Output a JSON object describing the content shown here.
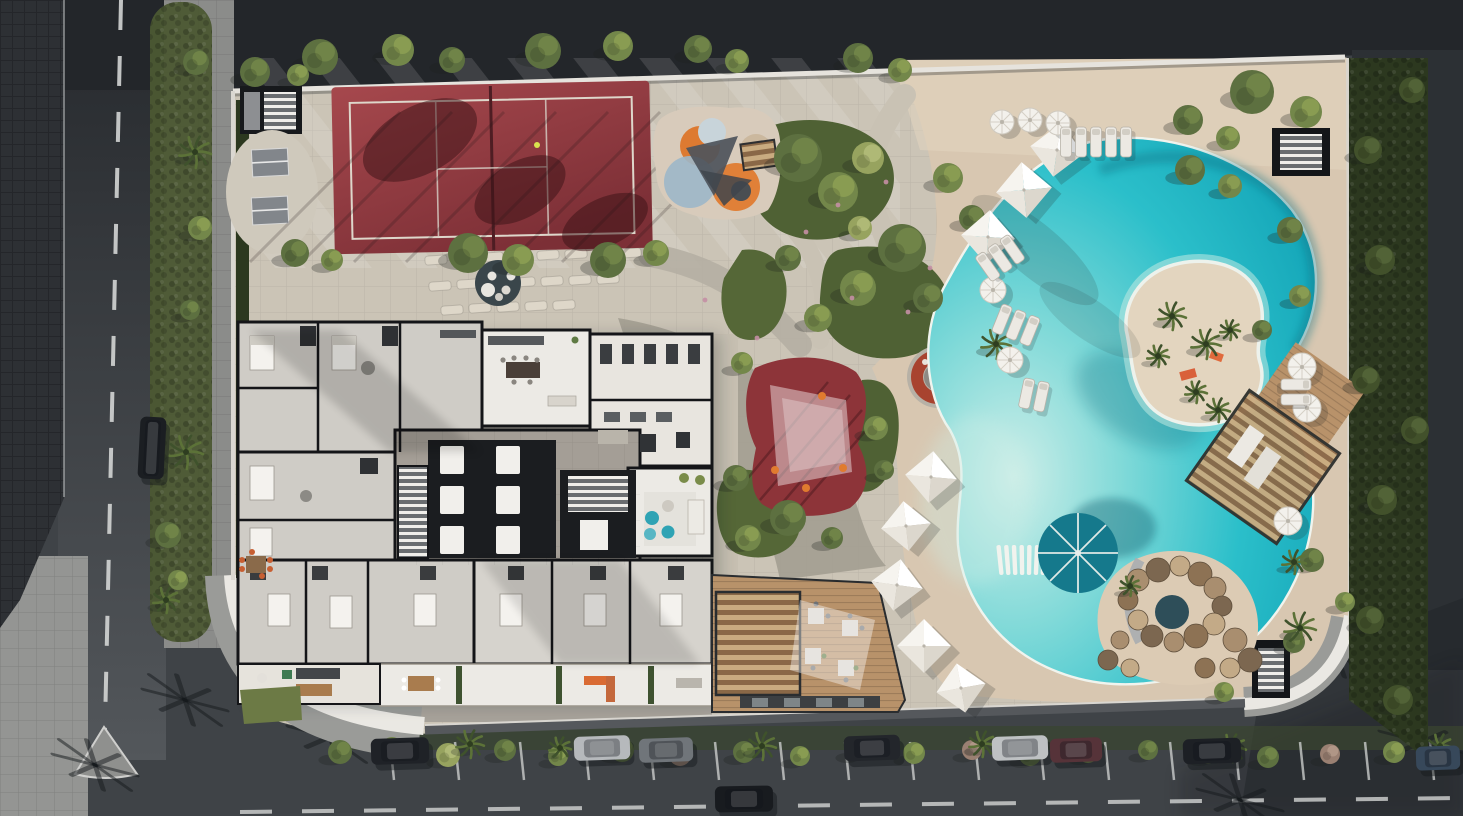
{
  "meta": {
    "title": "aerial-masterplan-render",
    "kind": "architectural-site-plan",
    "width": 1463,
    "height": 816
  },
  "scene": {
    "areas": [
      {
        "name": "sports-court",
        "label": "red multi-sport court"
      },
      {
        "name": "kids-playground",
        "label": "colorful playground"
      },
      {
        "name": "garden-paths",
        "label": "curved garden paths with planting"
      },
      {
        "name": "residential-floor-plan",
        "label": "cutaway apartment floor plan"
      },
      {
        "name": "red-play-surface",
        "label": "red play surface with shade sail"
      },
      {
        "name": "fire-pit-lounge",
        "label": "circular sunken fire pit lounge"
      },
      {
        "name": "lagoon-pool",
        "label": "freeform lagoon pool with island"
      },
      {
        "name": "bbq-deck",
        "label": "wood dining deck with pergola"
      },
      {
        "name": "rock-grotto",
        "label": "rock grotto spa"
      },
      {
        "name": "street-parking",
        "label": "street with parked cars"
      }
    ]
  },
  "palette": {
    "asphalt": "#3f4347",
    "asphalt_dark": "#23262a",
    "road_light": "#53575b",
    "roof": "#2d3034",
    "sidewalk": "#8b8c8a",
    "sidewalk_light": "#949593",
    "site_paving": "#cbc4b6",
    "paving_stripe": "#dad3c5",
    "sand": "#d8c7b1",
    "sand_light": "#e4d5c0",
    "path_gray": "#a49e93",
    "path_light": "#c9c2b4",
    "court_red": "#a6484d",
    "court_red_dark": "#7c2f36",
    "court_line": "#ded7cb",
    "red_play": "#8d3439",
    "red_play_dark": "#772b31",
    "rust": "#a8432f",
    "wood": "#b8926a",
    "wood_dark": "#8a6847",
    "wood_light": "#c9ab80",
    "plan_wall": "#141518",
    "plan_room_light": "#eceae5",
    "plan_room_gray": "#cfccc6",
    "plan_corridor": "#a49e96",
    "plan_core": "#1b1d20",
    "hedge": "#2c381f",
    "verge": "#4c5833",
    "grass": "#6c7a45",
    "pool_edge": "#cdeee8",
    "pool_shallow": "#7fd9d8",
    "pool_water": "#2bbfca",
    "pool_deep": "#0fa0b4",
    "island_sand": "#e3d5bf",
    "spa_water": "#2e4e59",
    "teal_umbrella": "#15798c",
    "teal_pouf": "#2fa3b4",
    "wall_white": "#e6e3dd",
    "wall_gray": "#55585c",
    "white_struct": "#f1efe9",
    "line_white": "#d3d5d4",
    "shadow": "#1b2025",
    "orange": "#d96b33",
    "rock": "#a98e6f",
    "rock_dark": "#7c6750",
    "rock_light": "#c3aa87",
    "stone": "#ded7c9",
    "car_glass": "#10151a",
    "tree_tones": [
      "#42512b",
      "#5d7040",
      "#73874a",
      "#97a35f",
      "#9a8072"
    ],
    "tree_highlights": [
      "#55663a",
      "#73874a",
      "#8da053",
      "#b3bd7a",
      "#b49a8a"
    ]
  },
  "objects": {
    "trees": [
      [
        320,
        57,
        18,
        1
      ],
      [
        398,
        50,
        16,
        2
      ],
      [
        452,
        60,
        13,
        1
      ],
      [
        543,
        51,
        18,
        1
      ],
      [
        618,
        46,
        15,
        2
      ],
      [
        698,
        49,
        14,
        1
      ],
      [
        737,
        61,
        12,
        2
      ],
      [
        858,
        58,
        15,
        1
      ],
      [
        900,
        70,
        12,
        2
      ],
      [
        255,
        72,
        15,
        1
      ],
      [
        298,
        75,
        11,
        2
      ],
      [
        1252,
        92,
        22,
        1
      ],
      [
        1306,
        112,
        16,
        2
      ],
      [
        1188,
        120,
        15,
        1
      ],
      [
        1228,
        138,
        12,
        2
      ],
      [
        798,
        158,
        24,
        1
      ],
      [
        838,
        192,
        20,
        2
      ],
      [
        868,
        158,
        16,
        3
      ],
      [
        902,
        248,
        24,
        1
      ],
      [
        858,
        288,
        18,
        2
      ],
      [
        928,
        298,
        15,
        1
      ],
      [
        818,
        318,
        14,
        2
      ],
      [
        788,
        258,
        13,
        1
      ],
      [
        948,
        178,
        15,
        2
      ],
      [
        972,
        218,
        13,
        1
      ],
      [
        860,
        228,
        12,
        3
      ],
      [
        468,
        253,
        20,
        1
      ],
      [
        518,
        260,
        16,
        2
      ],
      [
        608,
        260,
        18,
        1
      ],
      [
        656,
        253,
        13,
        2
      ],
      [
        295,
        253,
        14,
        1
      ],
      [
        332,
        260,
        11,
        2
      ],
      [
        1190,
        170,
        15,
        1
      ],
      [
        1230,
        186,
        12,
        2
      ],
      [
        1290,
        230,
        13,
        1
      ],
      [
        1300,
        296,
        11,
        2
      ],
      [
        1262,
        330,
        10,
        1
      ],
      [
        742,
        363,
        11,
        2
      ],
      [
        736,
        478,
        13,
        1
      ],
      [
        788,
        518,
        18,
        1
      ],
      [
        748,
        538,
        13,
        2
      ],
      [
        832,
        538,
        11,
        1
      ],
      [
        876,
        428,
        12,
        2
      ],
      [
        884,
        470,
        10,
        1
      ],
      [
        1312,
        560,
        12,
        1
      ],
      [
        1345,
        602,
        10,
        2
      ],
      [
        1294,
        642,
        11,
        1
      ],
      [
        1224,
        692,
        10,
        2
      ],
      [
        196,
        62,
        13,
        1
      ],
      [
        200,
        228,
        12,
        2
      ],
      [
        190,
        310,
        10,
        1
      ],
      [
        168,
        535,
        13,
        1
      ],
      [
        178,
        580,
        10,
        2
      ],
      [
        340,
        752,
        12,
        1
      ],
      [
        392,
        748,
        11,
        2
      ],
      [
        448,
        755,
        12,
        3
      ],
      [
        505,
        750,
        11,
        1
      ],
      [
        558,
        756,
        10,
        2
      ],
      [
        622,
        750,
        12,
        1
      ],
      [
        680,
        755,
        11,
        4
      ],
      [
        744,
        752,
        11,
        1
      ],
      [
        800,
        756,
        10,
        2
      ],
      [
        856,
        750,
        11,
        1
      ],
      [
        914,
        753,
        11,
        2
      ],
      [
        972,
        750,
        10,
        4
      ],
      [
        1030,
        755,
        11,
        1
      ],
      [
        1088,
        752,
        11,
        2
      ],
      [
        1148,
        750,
        10,
        1
      ],
      [
        1208,
        753,
        11,
        2
      ],
      [
        1268,
        757,
        11,
        1
      ],
      [
        1330,
        754,
        10,
        4
      ],
      [
        1394,
        752,
        11,
        2
      ],
      [
        1446,
        755,
        9,
        1
      ],
      [
        1368,
        150,
        14,
        0
      ],
      [
        1380,
        260,
        15,
        0
      ],
      [
        1366,
        380,
        14,
        0
      ],
      [
        1382,
        500,
        15,
        0
      ],
      [
        1370,
        620,
        14,
        0
      ],
      [
        1398,
        700,
        15,
        0
      ],
      [
        1412,
        90,
        13,
        0
      ],
      [
        1415,
        430,
        14,
        0
      ]
    ],
    "palms": [
      [
        195,
        152,
        16
      ],
      [
        186,
        452,
        17
      ],
      [
        166,
        600,
        13
      ],
      [
        996,
        344,
        15
      ],
      [
        1300,
        628,
        16
      ],
      [
        1294,
        562,
        12
      ],
      [
        470,
        744,
        14
      ],
      [
        762,
        746,
        14
      ],
      [
        982,
        744,
        13
      ],
      [
        1232,
        748,
        14
      ],
      [
        1440,
        746,
        12
      ],
      [
        560,
        748,
        11
      ],
      [
        1130,
        586,
        10
      ]
    ],
    "island_palms": [
      [
        1172,
        316,
        14
      ],
      [
        1206,
        344,
        15
      ],
      [
        1158,
        356,
        11
      ],
      [
        1196,
        392,
        11
      ],
      [
        1230,
        330,
        10
      ],
      [
        1218,
        410,
        12
      ]
    ],
    "pyramid_umbrellas": [
      [
        1057,
        150,
        54,
        8
      ],
      [
        1024,
        190,
        56,
        -5
      ],
      [
        988,
        237,
        54,
        4
      ],
      [
        931,
        477,
        52,
        5
      ],
      [
        906,
        526,
        50,
        -6
      ],
      [
        897,
        585,
        52,
        8
      ],
      [
        924,
        646,
        54,
        0
      ],
      [
        961,
        688,
        50,
        -10
      ]
    ],
    "round_umbrellas": [
      [
        1002,
        122,
        12
      ],
      [
        1030,
        120,
        12
      ],
      [
        1058,
        123,
        12
      ],
      [
        993,
        290,
        13
      ],
      [
        1010,
        360,
        13
      ],
      [
        1302,
        367,
        14
      ],
      [
        1307,
        408,
        14
      ],
      [
        1288,
        521,
        14
      ]
    ],
    "lounger_groups": [
      [
        1096,
        142,
        0,
        5
      ],
      [
        1000,
        258,
        -35,
        3
      ],
      [
        1016,
        325,
        22,
        3
      ],
      [
        1034,
        395,
        12,
        2
      ],
      [
        1296,
        392,
        90,
        2
      ]
    ],
    "pool_loungers": {
      "x": 1000,
      "y": 560,
      "count": 7,
      "step": 7.3
    },
    "cars": [
      [
        400,
        751,
        58,
        26,
        "#1f2227",
        -2
      ],
      [
        602,
        748,
        56,
        24,
        "#b6b9bc",
        -2
      ],
      [
        666,
        750,
        54,
        24,
        "#70757a",
        -2
      ],
      [
        744,
        799,
        58,
        26,
        "#181b1f",
        -1
      ],
      [
        872,
        748,
        56,
        25,
        "#23262b",
        -2
      ],
      [
        1020,
        748,
        56,
        24,
        "#bec1c3",
        -2
      ],
      [
        1076,
        750,
        52,
        24,
        "#563339",
        -2
      ],
      [
        1212,
        751,
        58,
        25,
        "#1d2025",
        -2
      ],
      [
        1438,
        758,
        44,
        24,
        "#37485a",
        -2
      ],
      [
        152,
        448,
        26,
        62,
        "#1b1e22",
        3
      ]
    ],
    "parking_line_xs": [
      390,
      455,
      520,
      585,
      650,
      715,
      780,
      845,
      910,
      975,
      1040,
      1105,
      1170,
      1235,
      1300,
      1365,
      1430
    ],
    "stepping_stones": [
      [
        436,
        260
      ],
      [
        464,
        258
      ],
      [
        492,
        257
      ],
      [
        520,
        256
      ],
      [
        548,
        255
      ],
      [
        576,
        254
      ],
      [
        604,
        254
      ],
      [
        630,
        253
      ],
      [
        440,
        286
      ],
      [
        468,
        284
      ],
      [
        496,
        283
      ],
      [
        524,
        282
      ],
      [
        552,
        281
      ],
      [
        580,
        280
      ],
      [
        608,
        279
      ],
      [
        452,
        310
      ],
      [
        480,
        308
      ],
      [
        508,
        307
      ],
      [
        536,
        306
      ],
      [
        564,
        305
      ]
    ],
    "palm_shadows": [
      [
        185,
        700
      ],
      [
        330,
        737
      ],
      [
        95,
        765
      ],
      [
        1336,
        652
      ],
      [
        1422,
        742
      ],
      [
        1240,
        800
      ]
    ],
    "flowers": [
      [
        838,
        205
      ],
      [
        852,
        298
      ],
      [
        908,
        312
      ],
      [
        757,
        338
      ],
      [
        886,
        182
      ],
      [
        806,
        232
      ],
      [
        930,
        268
      ],
      [
        705,
        300
      ]
    ],
    "grotto_rocks": [
      [
        1138,
        580,
        11
      ],
      [
        1158,
        570,
        12
      ],
      [
        1180,
        566,
        10
      ],
      [
        1200,
        574,
        12
      ],
      [
        1215,
        588,
        11
      ],
      [
        1222,
        606,
        10
      ],
      [
        1214,
        624,
        11
      ],
      [
        1196,
        636,
        12
      ],
      [
        1174,
        642,
        10
      ],
      [
        1152,
        636,
        11
      ],
      [
        1138,
        620,
        10
      ],
      [
        1128,
        600,
        10
      ],
      [
        1235,
        640,
        12
      ],
      [
        1250,
        660,
        12
      ],
      [
        1230,
        668,
        10
      ],
      [
        1205,
        668,
        10
      ],
      [
        1120,
        640,
        9
      ],
      [
        1108,
        660,
        10
      ],
      [
        1130,
        668,
        9
      ]
    ]
  }
}
